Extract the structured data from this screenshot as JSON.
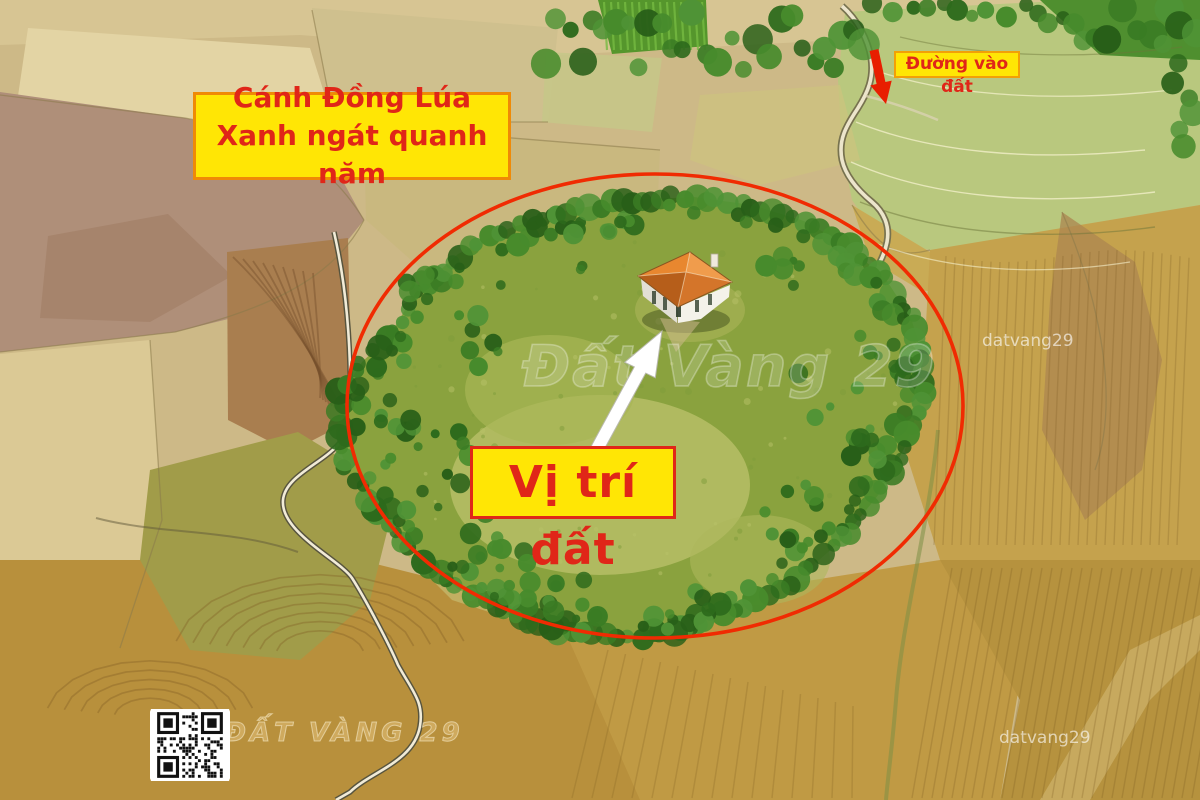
{
  "annotations": {
    "field_caption_line1": "Cánh Đồng Lúa",
    "field_caption_line2": "Xanh ngát quanh năm",
    "road_caption": "Đường vào đất",
    "location_caption": "Vị trí đất"
  },
  "watermarks": {
    "center": "Đất Vàng 29",
    "bottom_left": "ĐẤT VÀNG 29",
    "top_right_small": "datvang29",
    "bottom_right_small": "datvang29"
  },
  "icons": {
    "qr": "qr-code-icon",
    "red_arrow": "road-arrow-icon",
    "white_arrow": "location-pointer-arrow-icon"
  },
  "colors": {
    "caption_background": "#ffe605",
    "caption_text": "#e02618",
    "caption_border_orange": "#ef8a06",
    "caption_border_red": "#e02718",
    "boundary_ellipse": "#f02b02",
    "red_arrow": "#e81e00",
    "white_arrow": "#ffffff"
  }
}
